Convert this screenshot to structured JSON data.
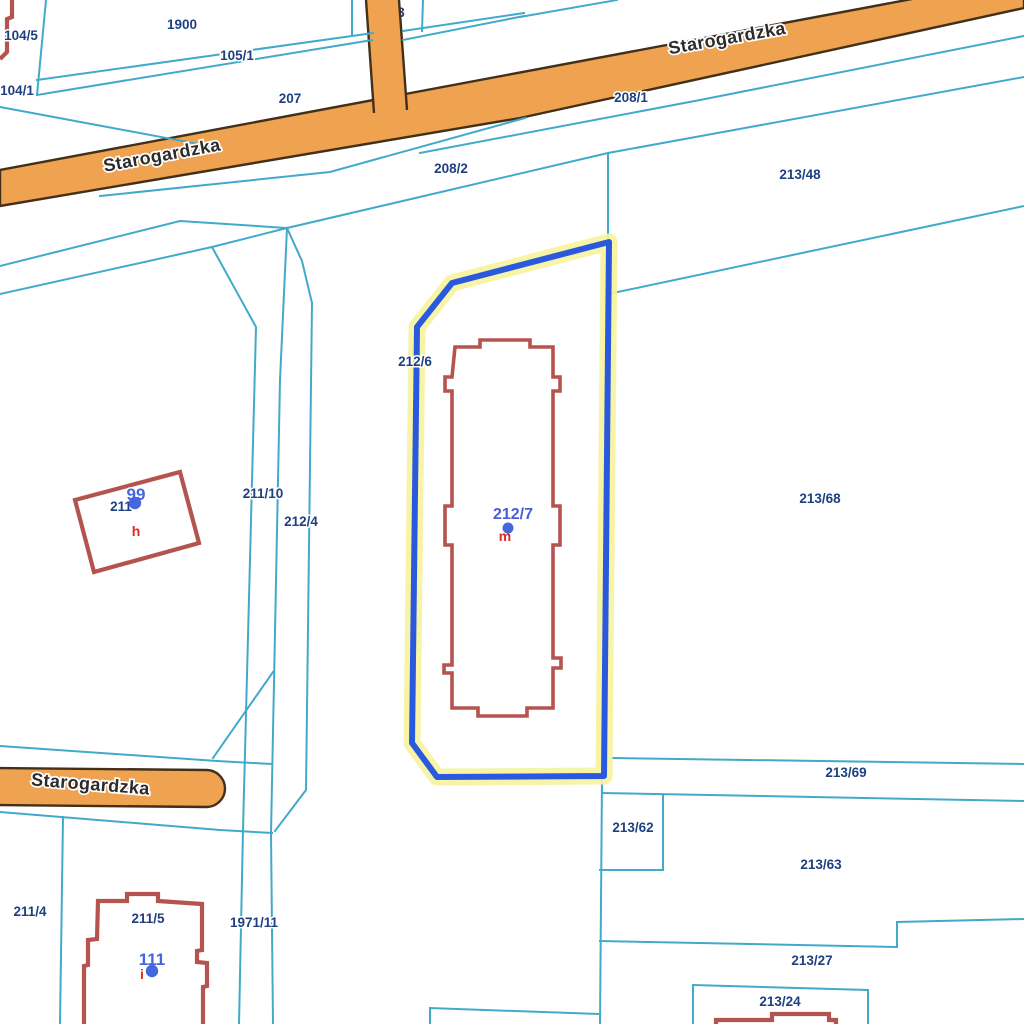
{
  "map": {
    "type": "cadastral-parcel-map",
    "background": "#ffffff",
    "colors": {
      "parcel_line": "#41AACA",
      "road_fill": "#EFA24F",
      "road_border": "#42301A",
      "road_label": "#2B2B2B",
      "selected_outline": "#2B59DD",
      "selected_halo": "#F6F3A0",
      "building_outline": "#B5534E",
      "parcel_label": "#1E4080",
      "selected_parcel_label": "#4A5CD8",
      "address_label": "#4466DE",
      "address_dot": "#4466DE",
      "building_letter": "#DD2B23"
    },
    "street_labels": [
      {
        "name": "Starogardzka",
        "x": 163,
        "y": 161,
        "rotation": -10.5
      },
      {
        "name": "Starogardzka",
        "x": 728,
        "y": 44,
        "rotation": -10
      },
      {
        "name": "Starogardzka",
        "x": 90,
        "y": 790,
        "rotation": 4.5
      }
    ],
    "parcel_labels": [
      {
        "id": "104/5",
        "x": 21,
        "y": 40
      },
      {
        "id": "1900",
        "x": 182,
        "y": 29
      },
      {
        "id": "105/1",
        "x": 237,
        "y": 60
      },
      {
        "id": "104/1",
        "x": 17,
        "y": 95
      },
      {
        "id": "207",
        "x": 290,
        "y": 103
      },
      {
        "id": "208/1",
        "x": 631,
        "y": 102
      },
      {
        "id": "208/2",
        "x": 451,
        "y": 173
      },
      {
        "id": "213/48",
        "x": 800,
        "y": 179
      },
      {
        "id": "213/68",
        "x": 820,
        "y": 503
      },
      {
        "id": "211/10",
        "x": 263,
        "y": 498
      },
      {
        "id": "212/4",
        "x": 301,
        "y": 526
      },
      {
        "id": "212/6",
        "x": 415,
        "y": 366
      },
      {
        "id": "211/4",
        "x": 30,
        "y": 916
      },
      {
        "id": "211/5",
        "x": 148,
        "y": 923
      },
      {
        "id": "1971/11",
        "x": 254,
        "y": 927
      },
      {
        "id": "213/69",
        "x": 846,
        "y": 777
      },
      {
        "id": "213/62",
        "x": 633,
        "y": 832
      },
      {
        "id": "213/63",
        "x": 821,
        "y": 869
      },
      {
        "id": "213/27",
        "x": 812,
        "y": 965
      },
      {
        "id": "213/24",
        "x": 780,
        "y": 1006
      }
    ],
    "selected_parcel": {
      "id": "212/7",
      "label_x": 513,
      "label_y": 519,
      "dot_x": 508,
      "dot_y": 528,
      "building_letter": "m",
      "letter_x": 505,
      "letter_y": 541
    },
    "address_points": [
      {
        "number": "99",
        "x": 136,
        "y": 500,
        "dot_x": 135,
        "dot_y": 503,
        "building_letter": "h",
        "letter_x": 136,
        "letter_y": 536,
        "parcel_fragment": "211",
        "fragment_x": 121,
        "fragment_y": 511
      },
      {
        "number": "111",
        "x": 152,
        "y": 965,
        "dot_x": 152,
        "dot_y": 971,
        "building_letter": "i",
        "letter_x": 142,
        "letter_y": 979
      }
    ],
    "partially_covered_labels": [
      {
        "text": "1",
        "x": 372,
        "y": 17
      },
      {
        "text": "3",
        "x": 401,
        "y": 17
      },
      {
        "text": "1971/12",
        "x": 133,
        "y": 780
      }
    ]
  }
}
